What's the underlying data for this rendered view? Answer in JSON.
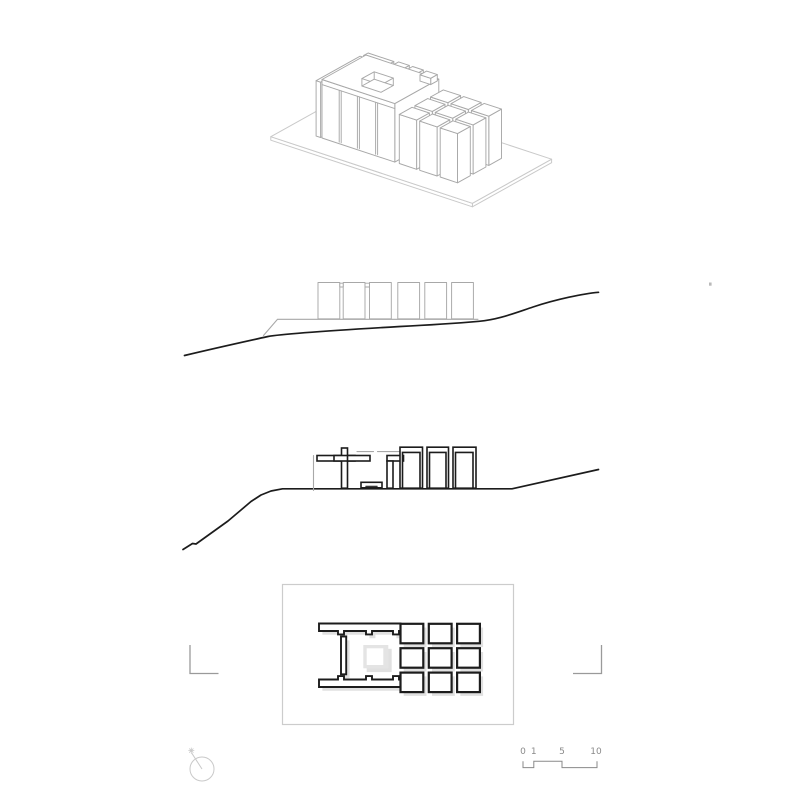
{
  "colors": {
    "paper": "#ffffff",
    "ink": "#1c1c1c",
    "light_line": "#a8a8a8",
    "faint_line": "#c9c9c9",
    "frame_line": "#cccccc",
    "courtyard_shade": "#e4e4e4",
    "drop_shadow": "#e0e0e0",
    "gray_text": "#8a8a8a",
    "cut_mark": "#9a9a9a"
  },
  "scale_bar": {
    "labels": [
      "0",
      "1",
      "5",
      "10"
    ]
  },
  "icons": {
    "north_arrow_icon": "circle-with-needle-and-sparkle-pointing-upper-left",
    "section_cut_mark_icon": "L-shaped-reference-bracket",
    "scale_bar_icon": "stepped-graphic-scale-0-1-5-10"
  }
}
